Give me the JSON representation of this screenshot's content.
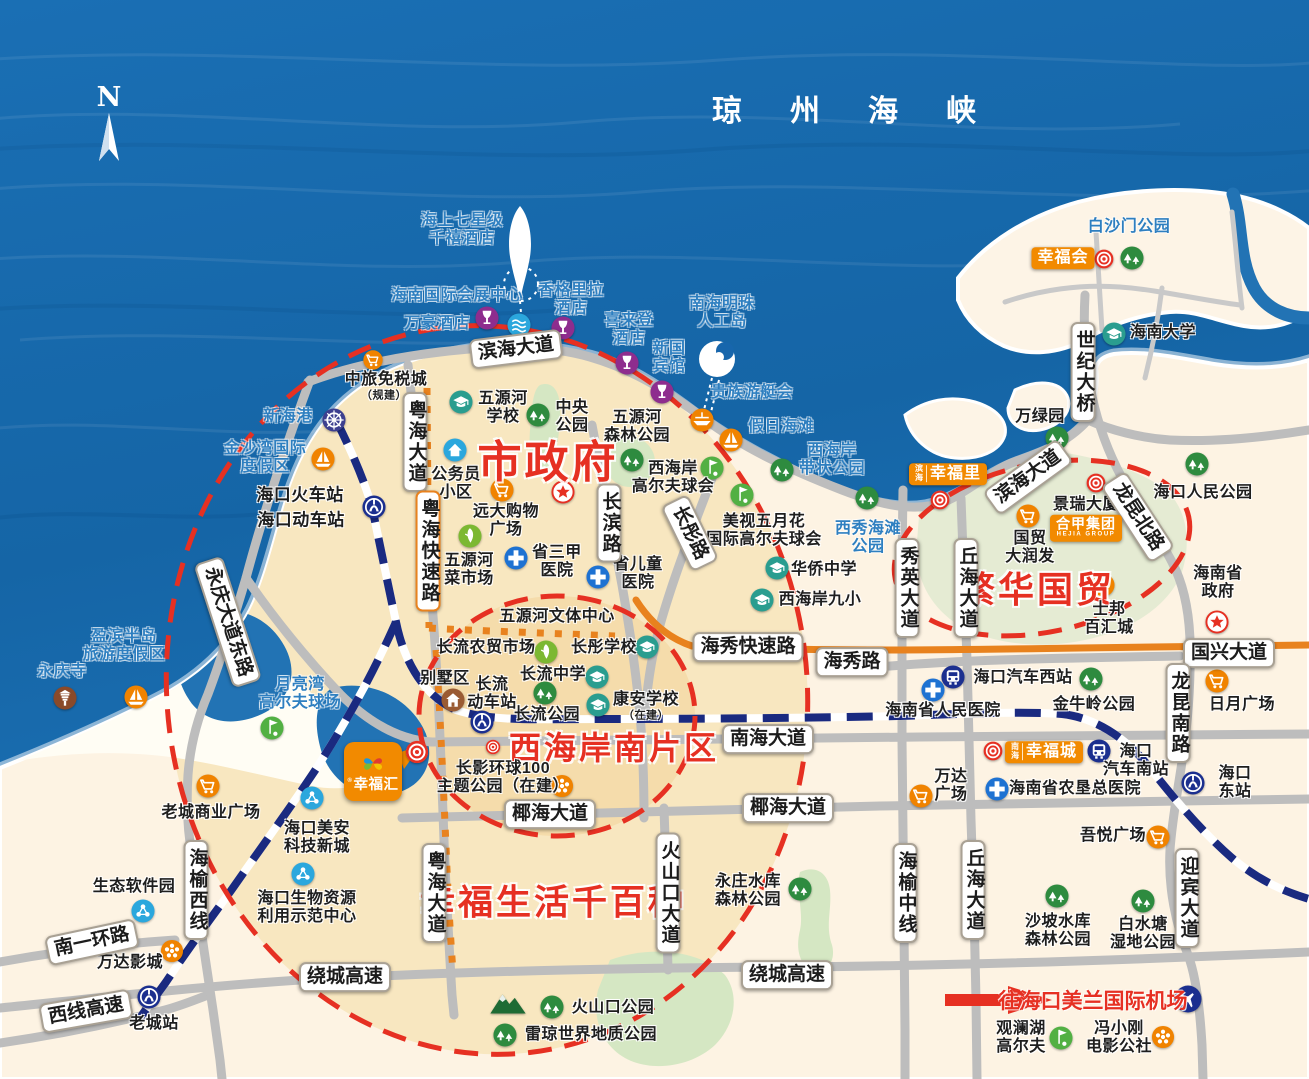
{
  "sea": {
    "title": "琼州海峡"
  },
  "compass": {
    "letter": "N"
  },
  "project": {
    "name": "幸福汇",
    "mark": "®"
  },
  "colors": {
    "sea": "#1766ac",
    "sea_text": "#2e7fc0",
    "land": "#fdf3e3",
    "land_tint": "#f8e7c0",
    "land_tint2": "#f5dcab",
    "green_zone": "#e5ebd3",
    "park": "#d5e7c3",
    "road": "#bdbdbd",
    "road_orange": "#e8821e",
    "rail_navy": "#1a2a80",
    "red": "#e63022",
    "brand_orange": "#f28a00"
  },
  "area_titles": [
    {
      "t": "市政府",
      "x": 548,
      "y": 458,
      "s": 44
    },
    {
      "t": "繁华国贸",
      "x": 1037,
      "y": 587,
      "s": 36
    },
    {
      "t": "西海岸南片区",
      "x": 614,
      "y": 746,
      "s": 32
    },
    {
      "t": "幸福生活千百种",
      "x": 553,
      "y": 900,
      "s": 35
    }
  ],
  "airport": {
    "t": "往海口美兰国际机场",
    "x": 1093,
    "y": 1000
  },
  "labels": [
    {
      "t": "海上七星级\n千禧酒店",
      "x": 462,
      "y": 230,
      "c": "sea"
    },
    {
      "t": "海南国际会展中心",
      "x": 457,
      "y": 296,
      "c": "sea"
    },
    {
      "t": "万豪酒店",
      "x": 437,
      "y": 324,
      "c": "sea"
    },
    {
      "t": "香格里拉\n酒店",
      "x": 571,
      "y": 300,
      "c": "sea"
    },
    {
      "t": "喜来登\n酒店",
      "x": 629,
      "y": 330,
      "c": "sea"
    },
    {
      "t": "新国\n宾馆",
      "x": 669,
      "y": 358,
      "c": "sea"
    },
    {
      "t": "南海明珠\n人工岛",
      "x": 722,
      "y": 313,
      "c": "sea"
    },
    {
      "t": "贵族游艇会",
      "x": 752,
      "y": 393,
      "c": "sea"
    },
    {
      "t": "假日海滩",
      "x": 781,
      "y": 427,
      "c": "sea"
    },
    {
      "t": "西海岸\n带状公园",
      "x": 832,
      "y": 460,
      "c": "sea"
    },
    {
      "t": "白沙门公园",
      "x": 1129,
      "y": 227,
      "c": "sea"
    },
    {
      "t": "新海港",
      "x": 288,
      "y": 417,
      "c": "sea"
    },
    {
      "t": "金沙湾国际\n度假区",
      "x": 265,
      "y": 458,
      "c": "sea"
    },
    {
      "t": "盈滨半岛\n旅游度假区",
      "x": 124,
      "y": 646,
      "c": "sea"
    },
    {
      "t": "永庆寺",
      "x": 62,
      "y": 672,
      "c": "sea"
    },
    {
      "t": "月亮湾\n高尔夫球场",
      "x": 300,
      "y": 694,
      "c": "sea"
    },
    {
      "t": "西秀海滩\n公园",
      "x": 868,
      "y": 538,
      "c": "sea"
    },
    {
      "t": "海口火车站",
      "x": 300,
      "y": 495,
      "c": "poi",
      "s": 17
    },
    {
      "t": "海口动车站",
      "x": 301,
      "y": 520,
      "c": "poi",
      "s": 17
    },
    {
      "t": "中旅免税城",
      "x": 386,
      "y": 380,
      "c": "poi"
    },
    {
      "t": "（规建）",
      "x": 384,
      "y": 396,
      "c": "poi",
      "s": 11
    },
    {
      "t": "公务员\n小区",
      "x": 456,
      "y": 484,
      "c": "poi"
    },
    {
      "t": "五源河\n学校",
      "x": 503,
      "y": 408,
      "c": "poi"
    },
    {
      "t": "中央\n公园",
      "x": 572,
      "y": 417,
      "c": "poi"
    },
    {
      "t": "五源河\n森林公园",
      "x": 637,
      "y": 427,
      "c": "poi"
    },
    {
      "t": "远大购物\n广场",
      "x": 506,
      "y": 521,
      "c": "poi"
    },
    {
      "t": "省三甲\n医院",
      "x": 557,
      "y": 562,
      "c": "poi"
    },
    {
      "t": "省儿童\n医院",
      "x": 638,
      "y": 574,
      "c": "poi"
    },
    {
      "t": "五源河\n菜市场",
      "x": 469,
      "y": 570,
      "c": "poi"
    },
    {
      "t": "西海岸\n高尔夫球会",
      "x": 673,
      "y": 478,
      "c": "poi"
    },
    {
      "t": "美视五月花\n国际高尔夫球会",
      "x": 764,
      "y": 531,
      "c": "poi"
    },
    {
      "t": "华侨中学",
      "x": 824,
      "y": 570,
      "c": "poi"
    },
    {
      "t": "西海岸九小",
      "x": 820,
      "y": 600,
      "c": "poi"
    },
    {
      "t": "海南大学",
      "x": 1163,
      "y": 333,
      "c": "poi"
    },
    {
      "t": "万绿园",
      "x": 1040,
      "y": 417,
      "c": "poi"
    },
    {
      "t": "海口人民公园",
      "x": 1203,
      "y": 493,
      "c": "poi"
    },
    {
      "t": "景瑞大厦",
      "x": 1086,
      "y": 505,
      "c": "poi"
    },
    {
      "t": "国贸\n大润发",
      "x": 1030,
      "y": 548,
      "c": "poi"
    },
    {
      "t": "士邦\n百汇城",
      "x": 1109,
      "y": 619,
      "c": "poi"
    },
    {
      "t": "海南省\n政府",
      "x": 1218,
      "y": 583,
      "c": "poi"
    },
    {
      "t": "五源河文体中心",
      "x": 557,
      "y": 617,
      "c": "poi"
    },
    {
      "t": "长流农贸市场",
      "x": 486,
      "y": 648,
      "c": "poi"
    },
    {
      "t": "长彤学校",
      "x": 604,
      "y": 648,
      "c": "poi"
    },
    {
      "t": "长流中学",
      "x": 553,
      "y": 675,
      "c": "poi"
    },
    {
      "t": "别墅区",
      "x": 445,
      "y": 679,
      "c": "poi"
    },
    {
      "t": "长流\n动车站",
      "x": 492,
      "y": 694,
      "c": "poi"
    },
    {
      "t": "长流公园",
      "x": 547,
      "y": 715,
      "c": "poi"
    },
    {
      "t": "康安学校",
      "x": 646,
      "y": 700,
      "c": "poi"
    },
    {
      "t": "（在建）",
      "x": 646,
      "y": 716,
      "c": "poi",
      "s": 11
    },
    {
      "t": "长影环球100\n主题公园（在建）",
      "x": 503,
      "y": 778,
      "c": "poi"
    },
    {
      "t": "海口美安\n科技新城",
      "x": 317,
      "y": 838,
      "c": "poi"
    },
    {
      "t": "老城商业广场",
      "x": 211,
      "y": 813,
      "c": "poi"
    },
    {
      "t": "生态软件园",
      "x": 134,
      "y": 887,
      "c": "poi"
    },
    {
      "t": "万达影城",
      "x": 130,
      "y": 963,
      "c": "poi"
    },
    {
      "t": "老城站",
      "x": 154,
      "y": 1024,
      "c": "poi"
    },
    {
      "t": "海口生物资源\n利用示范中心",
      "x": 307,
      "y": 908,
      "c": "poi"
    },
    {
      "t": "海口汽车西站",
      "x": 1023,
      "y": 678,
      "c": "poi"
    },
    {
      "t": "金牛岭公园",
      "x": 1094,
      "y": 705,
      "c": "poi"
    },
    {
      "t": "海南省人民医院",
      "x": 943,
      "y": 711,
      "c": "poi"
    },
    {
      "t": "日月广场",
      "x": 1242,
      "y": 705,
      "c": "poi"
    },
    {
      "t": "海口\n汽车南站",
      "x": 1136,
      "y": 761,
      "c": "poi"
    },
    {
      "t": "海南省农垦总医院",
      "x": 1075,
      "y": 789,
      "c": "poi"
    },
    {
      "t": "万达\n广场",
      "x": 951,
      "y": 786,
      "c": "poi"
    },
    {
      "t": "海口\n东站",
      "x": 1235,
      "y": 783,
      "c": "poi"
    },
    {
      "t": "吾悦广场",
      "x": 1113,
      "y": 836,
      "c": "poi"
    },
    {
      "t": "沙坡水库\n森林公园",
      "x": 1058,
      "y": 931,
      "c": "poi"
    },
    {
      "t": "白水塘\n湿地公园",
      "x": 1143,
      "y": 934,
      "c": "poi"
    },
    {
      "t": "永庄水库\n森林公园",
      "x": 748,
      "y": 891,
      "c": "poi"
    },
    {
      "t": "火山口公园",
      "x": 613,
      "y": 1008,
      "c": "poi"
    },
    {
      "t": "雷琼世界地质公园",
      "x": 591,
      "y": 1035,
      "c": "poi"
    },
    {
      "t": "观澜湖\n高尔夫",
      "x": 1021,
      "y": 1038,
      "c": "poi"
    },
    {
      "t": "冯小刚\n电影公社",
      "x": 1119,
      "y": 1038,
      "c": "poi"
    }
  ],
  "road_labels": [
    {
      "t": "滨海大道",
      "x": 516,
      "y": 349,
      "r": -7
    },
    {
      "t": "滨海大道",
      "x": 1028,
      "y": 477,
      "r": -36
    },
    {
      "t": "粤海大道",
      "x": 415,
      "y": 442,
      "v": 1
    },
    {
      "t": "粤海快速路",
      "x": 428,
      "y": 551,
      "v": 1,
      "a": 1
    },
    {
      "t": "粤海大道",
      "x": 434,
      "y": 893,
      "v": 1
    },
    {
      "t": "长滨路",
      "x": 609,
      "y": 523,
      "v": 1
    },
    {
      "t": "长彤路",
      "x": 690,
      "y": 533,
      "r": 64
    },
    {
      "t": "永庆大道东路",
      "x": 228,
      "y": 622,
      "r": 72
    },
    {
      "t": "海秀快速路",
      "x": 748,
      "y": 647
    },
    {
      "t": "海秀路",
      "x": 852,
      "y": 662
    },
    {
      "t": "国兴大道",
      "x": 1229,
      "y": 653
    },
    {
      "t": "秀英大道",
      "x": 907,
      "y": 588,
      "v": 1
    },
    {
      "t": "丘海大道",
      "x": 966,
      "y": 588,
      "v": 1
    },
    {
      "t": "南海大道",
      "x": 768,
      "y": 739
    },
    {
      "t": "椰海大道",
      "x": 550,
      "y": 814
    },
    {
      "t": "椰海大道",
      "x": 788,
      "y": 808
    },
    {
      "t": "绕城高速",
      "x": 345,
      "y": 977
    },
    {
      "t": "绕城高速",
      "x": 787,
      "y": 975
    },
    {
      "t": "火山口大道",
      "x": 668,
      "y": 893,
      "v": 1
    },
    {
      "t": "海榆中线",
      "x": 905,
      "y": 893,
      "v": 1
    },
    {
      "t": "丘海大道",
      "x": 973,
      "y": 890,
      "v": 1
    },
    {
      "t": "迎宾大道",
      "x": 1187,
      "y": 898,
      "v": 1
    },
    {
      "t": "龙昆南路",
      "x": 1178,
      "y": 713,
      "v": 1
    },
    {
      "t": "龙昆北路",
      "x": 1138,
      "y": 517,
      "r": 57
    },
    {
      "t": "世纪大桥",
      "x": 1083,
      "y": 372,
      "v": 1
    },
    {
      "t": "海榆西线",
      "x": 196,
      "y": 890,
      "v": 1
    },
    {
      "t": "南一环路",
      "x": 92,
      "y": 942,
      "r": -12
    },
    {
      "t": "西线高速",
      "x": 86,
      "y": 1011,
      "r": -10
    }
  ],
  "brands": [
    {
      "text": "幸福会",
      "x": 1063,
      "y": 258
    },
    {
      "text": "幸福里",
      "prefix": "滨海",
      "x": 948,
      "y": 474
    },
    {
      "text": "幸福城",
      "prefix": "南海",
      "x": 1044,
      "y": 752
    },
    {
      "text": "合甲集团",
      "sub": "HEJIA GROUP",
      "x": 1086,
      "y": 528
    }
  ],
  "icons": [
    {
      "k": "park",
      "x": 1132,
      "y": 258
    },
    {
      "k": "park",
      "x": 1057,
      "y": 438
    },
    {
      "k": "park",
      "x": 1197,
      "y": 464
    },
    {
      "k": "park",
      "x": 538,
      "y": 415
    },
    {
      "k": "park",
      "x": 632,
      "y": 460
    },
    {
      "k": "park",
      "x": 782,
      "y": 470
    },
    {
      "k": "park",
      "x": 867,
      "y": 498
    },
    {
      "k": "park",
      "x": 1091,
      "y": 679
    },
    {
      "k": "park",
      "x": 545,
      "y": 693
    },
    {
      "k": "park",
      "x": 800,
      "y": 889
    },
    {
      "k": "park",
      "x": 1057,
      "y": 896
    },
    {
      "k": "park",
      "x": 1143,
      "y": 901
    },
    {
      "k": "park",
      "x": 552,
      "y": 1007
    },
    {
      "k": "park",
      "x": 505,
      "y": 1035
    },
    {
      "k": "school",
      "x": 1114,
      "y": 334
    },
    {
      "k": "school",
      "x": 461,
      "y": 402
    },
    {
      "k": "school",
      "x": 777,
      "y": 568
    },
    {
      "k": "school",
      "x": 762,
      "y": 600
    },
    {
      "k": "school",
      "x": 647,
      "y": 647
    },
    {
      "k": "school",
      "x": 597,
      "y": 677
    },
    {
      "k": "school",
      "x": 598,
      "y": 705
    },
    {
      "k": "hospital",
      "x": 516,
      "y": 558
    },
    {
      "k": "hospital",
      "x": 598,
      "y": 577
    },
    {
      "k": "hospital",
      "x": 933,
      "y": 690
    },
    {
      "k": "hospital",
      "x": 997,
      "y": 789
    },
    {
      "k": "golf",
      "x": 712,
      "y": 468
    },
    {
      "k": "golf",
      "x": 742,
      "y": 495
    },
    {
      "k": "golf",
      "x": 272,
      "y": 728
    },
    {
      "k": "golf",
      "x": 1061,
      "y": 1038
    },
    {
      "k": "wine",
      "x": 487,
      "y": 318
    },
    {
      "k": "wine",
      "x": 563,
      "y": 328
    },
    {
      "k": "wine",
      "x": 627,
      "y": 363
    },
    {
      "k": "wine",
      "x": 662,
      "y": 392
    },
    {
      "k": "waves",
      "x": 519,
      "y": 325
    },
    {
      "k": "rail",
      "x": 374,
      "y": 507
    },
    {
      "k": "rail",
      "x": 482,
      "y": 722
    },
    {
      "k": "rail",
      "x": 149,
      "y": 997
    },
    {
      "k": "rail",
      "x": 1193,
      "y": 783
    },
    {
      "k": "bus",
      "x": 953,
      "y": 677
    },
    {
      "k": "bus",
      "x": 1099,
      "y": 751
    },
    {
      "k": "cart",
      "x": 502,
      "y": 490
    },
    {
      "k": "cart",
      "x": 208,
      "y": 786
    },
    {
      "k": "cart",
      "x": 1028,
      "y": 516
    },
    {
      "k": "cart",
      "x": 1103,
      "y": 585
    },
    {
      "k": "cart",
      "x": 921,
      "y": 796
    },
    {
      "k": "cart",
      "x": 1158,
      "y": 837
    },
    {
      "k": "cart",
      "x": 1217,
      "y": 681
    },
    {
      "k": "cart",
      "x": 373,
      "y": 360,
      "s": 21
    },
    {
      "k": "film",
      "x": 562,
      "y": 786
    },
    {
      "k": "film",
      "x": 172,
      "y": 951
    },
    {
      "k": "film",
      "x": 1163,
      "y": 1037
    },
    {
      "k": "target",
      "x": 1104,
      "y": 259,
      "s": 22
    },
    {
      "k": "target",
      "x": 940,
      "y": 500,
      "s": 22
    },
    {
      "k": "target",
      "x": 1096,
      "y": 483,
      "s": 22
    },
    {
      "k": "target",
      "x": 993,
      "y": 751,
      "s": 22
    },
    {
      "k": "target",
      "x": 493,
      "y": 747,
      "s": 17
    },
    {
      "k": "target",
      "x": 417,
      "y": 752,
      "s": 26
    },
    {
      "k": "star",
      "x": 563,
      "y": 492
    },
    {
      "k": "star",
      "x": 1217,
      "y": 622
    },
    {
      "k": "home",
      "x": 455,
      "y": 450
    },
    {
      "k": "market",
      "x": 470,
      "y": 536
    },
    {
      "k": "market",
      "x": 546,
      "y": 652
    },
    {
      "k": "wheel",
      "x": 334,
      "y": 420
    },
    {
      "k": "sail",
      "x": 323,
      "y": 459
    },
    {
      "k": "sail",
      "x": 731,
      "y": 440
    },
    {
      "k": "sail",
      "x": 136,
      "y": 697
    },
    {
      "k": "yacht",
      "x": 702,
      "y": 420
    },
    {
      "k": "pagoda",
      "x": 65,
      "y": 698
    },
    {
      "k": "villa",
      "x": 453,
      "y": 700
    },
    {
      "k": "tech",
      "x": 312,
      "y": 798
    },
    {
      "k": "tech",
      "x": 143,
      "y": 911
    },
    {
      "k": "tech",
      "x": 303,
      "y": 874
    },
    {
      "k": "plane",
      "x": 1188,
      "y": 999,
      "s": 28
    },
    {
      "k": "mountain",
      "x": 508,
      "y": 1004,
      "s": 38
    }
  ]
}
